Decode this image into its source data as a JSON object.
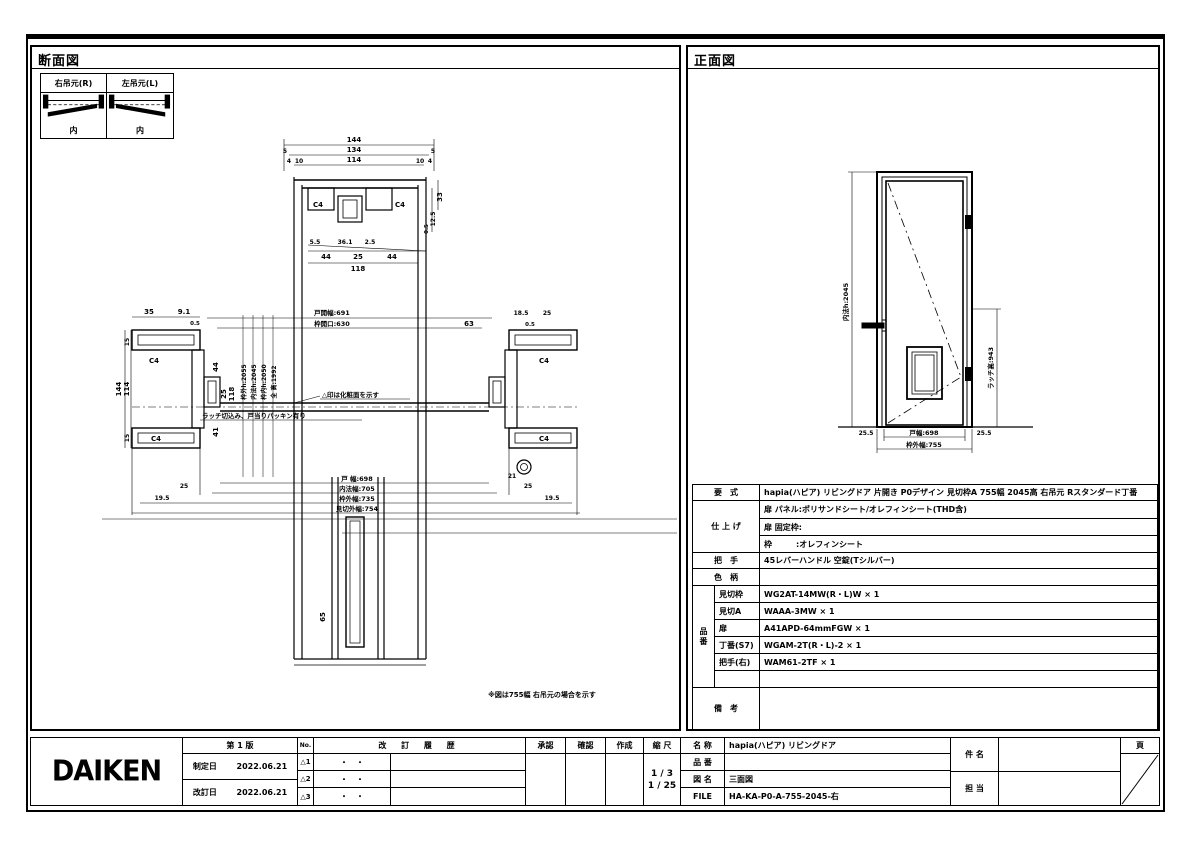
{
  "left_view": {
    "title": "断面図",
    "swing": {
      "right_label": "右吊元(R)",
      "left_label": "左吊元(L)",
      "inner1": "内",
      "inner2": "内"
    },
    "head": {
      "d144": "144",
      "d134": "134",
      "d114": "114",
      "d5a": "5",
      "d5b": "5",
      "d4a": "4",
      "d10a": "10",
      "d10b": "10",
      "d4b": "4",
      "c4a": "C4",
      "c4b": "C4",
      "d33": "33",
      "d125": "12.5",
      "d05": "0.5",
      "d55": "5.5",
      "d361": "36.1",
      "d25": "2.5",
      "d44a": "44",
      "d25c": "25",
      "d44b": "44",
      "d118": "118"
    },
    "plan": {
      "d35": "35",
      "d91": "9.1",
      "d05a": "0.5",
      "top1": "戸開幅:691",
      "top2": "枠開口:630",
      "d63": "63",
      "d185": "18.5",
      "d25r": "25",
      "d05b": "0.5",
      "d15a": "15",
      "d114": "114",
      "d144": "144",
      "d15b": "15",
      "c4a": "C4",
      "c4b": "C4",
      "c4c": "C4",
      "c4d": "C4",
      "d44": "44",
      "d25": "25",
      "d118": "118",
      "d41": "41",
      "h1": "枠外h:2055",
      "h2": "内法h:2045",
      "h3": "枠内h:2050",
      "h4": "全 高:1992",
      "note1": "△印は化粧面を示す",
      "note2": "ラッチ切込み、戸当りパッキン有り",
      "b25l": "25",
      "b195l": "19.5",
      "b21": "21",
      "b25r": "25",
      "b195r": "19.5",
      "w1": "戸 幅:698",
      "w2": "内法幅:705",
      "w3": "枠外幅:735",
      "w4": "見切外幅:754",
      "d65": "65"
    },
    "note_bottom": "※図は755幅 右吊元の場合を示す"
  },
  "right_view": {
    "title": "正面図",
    "dims": {
      "height": "内法h:2045",
      "latch": "ラッチ高:943",
      "left": "25.5",
      "width": "戸幅:698",
      "right": "25.5",
      "total": "枠外幅:755"
    }
  },
  "spec": {
    "youshiki_label": "要　式",
    "youshiki": "hapia(ハピア)  リビングドア  片開き  P0デザイン  見切枠A  755幅  2045高  右吊元  Rスタンダード丁番",
    "shiage_label": "仕 上 げ",
    "shiage1": "扉 パネル:ポリサンドシート/オレフィンシート(THD含)",
    "shiage2": "扉 固定枠:",
    "shiage3": "枠　　　:オレフィンシート",
    "hand_label": "把　手",
    "hand": "45レバーハンドル 空錠(Tシルバー)",
    "iro_label": "色　柄",
    "iro": "",
    "hinban_label": "品番",
    "parts": [
      {
        "name": "見切枠",
        "value": "WG2AT-14MW(R・L)W × 1"
      },
      {
        "name": "見切A",
        "value": "WAAA-3MW × 1"
      },
      {
        "name": "扉",
        "value": "A41APD-64mmFGW × 1"
      },
      {
        "name": "丁番(S7)",
        "value": "WGAM-2T(R・L)-2 × 1"
      },
      {
        "name": "把手(右)",
        "value": "WAM61-2TF × 1"
      },
      {
        "name": "",
        "value": ""
      }
    ],
    "biko_label": "備　考",
    "biko": ""
  },
  "title_block": {
    "logo": "DAIKEN",
    "edition": "第 1 版",
    "seitei_label": "制定日",
    "seitei_date": "2022.06.21",
    "kaitei_label": "改訂日",
    "kaitei_date": "2022.06.21",
    "no_label": "No.",
    "history_label": "改 訂 履 歴",
    "rev_rows": [
      {
        "mark": "△1",
        "date": "・　・"
      },
      {
        "mark": "△2",
        "date": "・　・"
      },
      {
        "mark": "△3",
        "date": "・　・"
      }
    ],
    "approve_label": "承認",
    "check_label": "確認",
    "create_label": "作成",
    "scale_label": "縮 尺",
    "scale1": "1 / 3",
    "scale2": "1 / 25",
    "name_label": "名 称",
    "name_value": "hapia(ハピア)  リビングドア",
    "hinban_label": "品 番",
    "hinban_value": "",
    "zumei_label": "図 名",
    "zumei_value": "三面図",
    "file_label": "FILE",
    "file_value": "HA-KA-P0-A-755-2045-右",
    "kenmei_label": "件 名",
    "tanto_label": "担 当",
    "page_label": "頁"
  }
}
